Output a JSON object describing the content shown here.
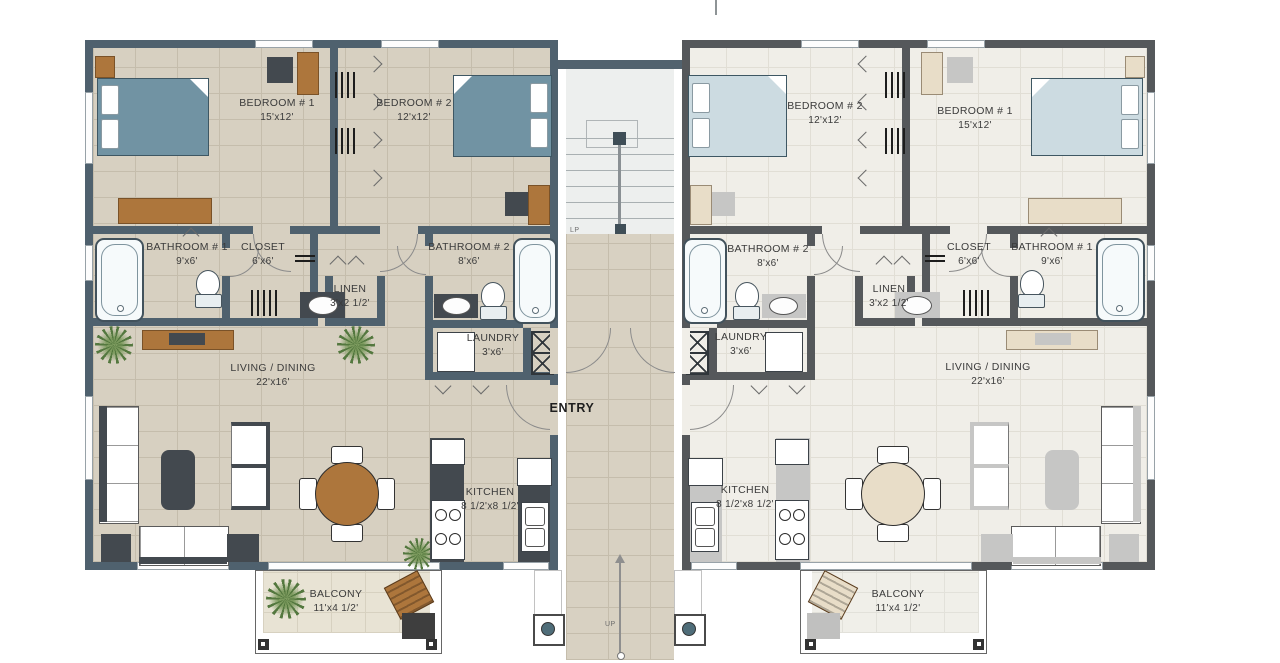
{
  "title": "Two-unit apartment floor plan",
  "left": {
    "bedroom1": {
      "name": "BEDROOM # 1",
      "dims": "15'x12'"
    },
    "bedroom2": {
      "name": "BEDROOM # 2",
      "dims": "12'x12'"
    },
    "bathroom1": {
      "name": "BATHROOM # 1",
      "dims": "9'x6'"
    },
    "bathroom2": {
      "name": "BATHROOM # 2",
      "dims": "8'x6'"
    },
    "closet": {
      "name": "CLOSET",
      "dims": "6'x6'"
    },
    "linen": {
      "name": "LINEN",
      "dims": "3'x2 1/2'"
    },
    "laundry": {
      "name": "LAUNDRY",
      "dims": "3'x6'"
    },
    "living": {
      "name": "LIVING / DINING",
      "dims": "22'x16'"
    },
    "kitchen": {
      "name": "KITCHEN",
      "dims": "8 1/2'x8 1/2'"
    },
    "balcony": {
      "name": "BALCONY",
      "dims": "11'x4 1/2'"
    }
  },
  "right": {
    "bedroom1": {
      "name": "BEDROOM # 1",
      "dims": "15'x12'"
    },
    "bedroom2": {
      "name": "BEDROOM # 2",
      "dims": "12'x12'"
    },
    "bathroom1": {
      "name": "BATHROOM # 1",
      "dims": "9'x6'"
    },
    "bathroom2": {
      "name": "BATHROOM # 2",
      "dims": "8'x6'"
    },
    "closet": {
      "name": "CLOSET",
      "dims": "6'x6'"
    },
    "linen": {
      "name": "LINEN",
      "dims": "3'x2 1/2'"
    },
    "laundry": {
      "name": "LAUNDRY",
      "dims": "3'x6'"
    },
    "living": {
      "name": "LIVING / DINING",
      "dims": "22'x16'"
    },
    "kitchen": {
      "name": "KITCHEN",
      "dims": "8 1/2'x8 1/2'"
    },
    "balcony": {
      "name": "BALCONY",
      "dims": "11'x4 1/2'"
    }
  },
  "center": {
    "entry": "ENTRY",
    "up": "UP",
    "lp": "LP"
  },
  "colors": {
    "wall_left_unit": "#4f616e",
    "wall_right_unit": "#55585b",
    "floor_left_unit": "#d7d0c1",
    "floor_right_unit": "#f0eee8",
    "bed_left_unit": "#7193a3",
    "bed_right_unit": "#ccdbe1",
    "wood_furniture": "#ad763c",
    "dark_furniture": "#43494f",
    "column_accent": "#4f6d79"
  }
}
